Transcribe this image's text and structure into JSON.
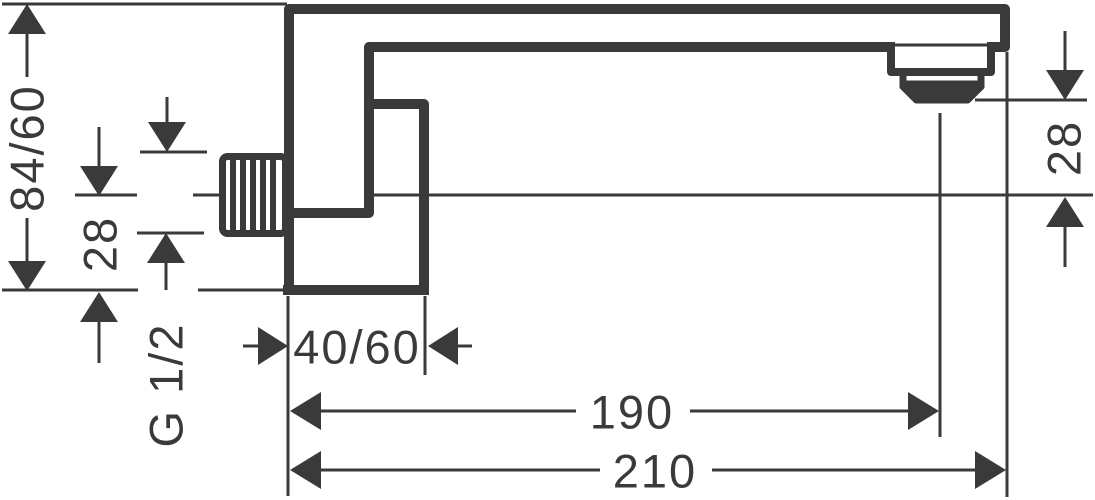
{
  "drawing": {
    "background": "#ffffff",
    "line_color": "#3a3a3a",
    "labels": {
      "overall_height": "84/60",
      "axis_to_bottom": "28",
      "thread": "G 1/2",
      "base_depth": "40/60",
      "reach_to_outlet": "190",
      "overall_length": "210",
      "outlet_offset": "28"
    }
  }
}
